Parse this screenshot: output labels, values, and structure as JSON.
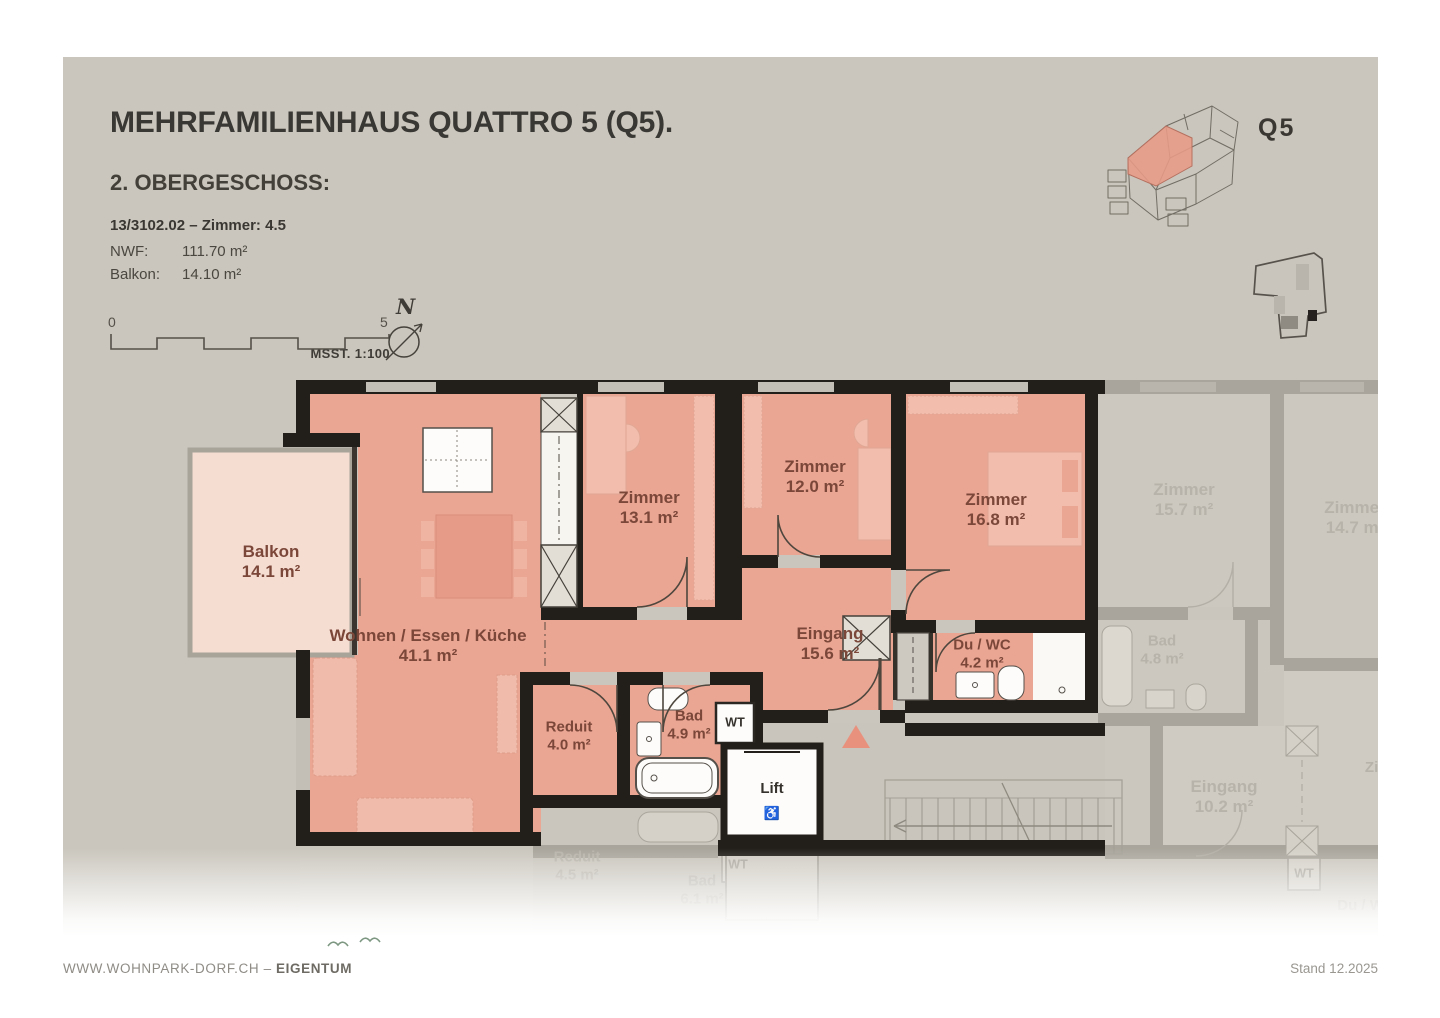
{
  "header": {
    "title": "MEHRFAMILIENHAUS QUATTRO 5 (Q5).",
    "floor": "2. OBERGESCHOSS:",
    "unit": "13/3102.02 – Zimmer: 4.5",
    "nwf_label": "NWF:",
    "nwf_value": "111.70 m²",
    "balkon_label": "Balkon:",
    "balkon_value": "14.10 m²"
  },
  "scalebar": {
    "start": "0",
    "end": "5",
    "label": "MSST. 1:100"
  },
  "compass": {
    "n": "N"
  },
  "overview": {
    "badge": "Q5"
  },
  "rooms": [
    {
      "name": "Balkon",
      "area": "14.1 m²"
    },
    {
      "name": "Wohnen / Essen / Küche",
      "area": "41.1 m²"
    },
    {
      "name": "Zimmer",
      "area": "13.1 m²"
    },
    {
      "name": "Zimmer",
      "area": "12.0 m²"
    },
    {
      "name": "Zimmer",
      "area": "16.8 m²"
    },
    {
      "name": "Eingang",
      "area": "15.6 m²"
    },
    {
      "name": "Du / WC",
      "area": "4.2 m²"
    },
    {
      "name": "Reduit",
      "area": "4.0 m²"
    },
    {
      "name": "Bad",
      "area": "4.9 m²"
    }
  ],
  "fixtures": {
    "wt": "WT",
    "lift": "Lift",
    "wheelchair": "♿"
  },
  "faded_rooms": [
    {
      "name": "Zimmer",
      "area": "15.7 m²"
    },
    {
      "name": "Zimmer",
      "area": "14.7 m²"
    },
    {
      "name": "Bad",
      "area": "4.8 m²"
    },
    {
      "name": "Eingang",
      "area": "10.2 m²"
    },
    {
      "name": "Reduit",
      "area": "4.5 m²"
    },
    {
      "name": "Bad",
      "area": "6.1 m²"
    },
    {
      "name": "Zimmer",
      "area": ""
    },
    {
      "name": "Du / WC",
      "area": ""
    }
  ],
  "footer": {
    "left_normal": "WWW.WOHNPARK-DORF.CH – ",
    "left_bold": "EIGENTUM",
    "right": "Stand 12.2025"
  },
  "colors": {
    "panel": "#cac6bd",
    "wall": "#221e19",
    "room": "#eba593",
    "balcony": "#f6ddd2",
    "accent_triangle": "#e8927e",
    "label": "#7b4739"
  }
}
